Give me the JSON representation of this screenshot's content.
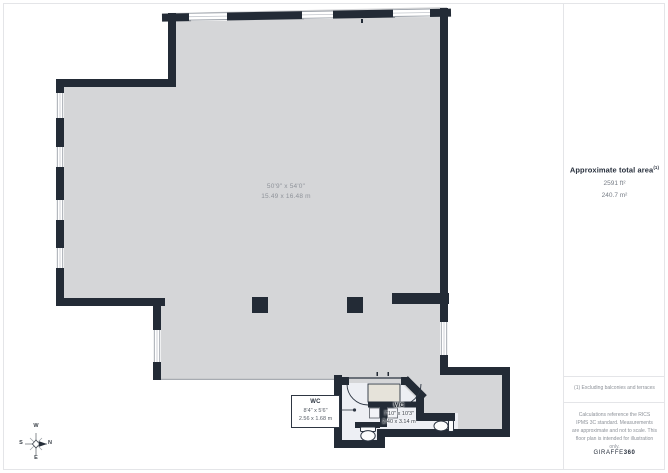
{
  "plan": {
    "main_room": {
      "dims_ft": "50'9\" x 54'0\"",
      "dims_m": "15.49 x 16.48 m"
    },
    "wc_small": {
      "name": "WC",
      "dims_ft": "8'4\" x 5'6\"",
      "dims_m": "2.56 x 1.68 m"
    },
    "wc_large": {
      "name": "WC",
      "dims_ft": "7'10\" x 10'3\"",
      "dims_m": "2.40 x 3.14 m"
    },
    "compass": {
      "top": "W",
      "right": "N",
      "left": "S",
      "bottom": "E"
    }
  },
  "sidebar": {
    "area_heading": "Approximate total area",
    "area_footnote_ref": "(1)",
    "area_ft": "2591 ft²",
    "area_m": "240.7 m²",
    "footnote": "(1) Excluding balconies and terraces",
    "disclaimer": "Calculations reference the RICS IPMS 3C standard. Measurements are approximate and not to scale. This floor plan is intended for illustration only.",
    "brand_name": "GIRAFFE",
    "brand_suffix": "360"
  },
  "colors": {
    "wall": "#232b36",
    "floor": "#d5d6d8",
    "wet_floor": "#edeff4",
    "vanity": "#e6e3da",
    "heading_text": "#272f3c",
    "muted_text": "#8c9198"
  }
}
